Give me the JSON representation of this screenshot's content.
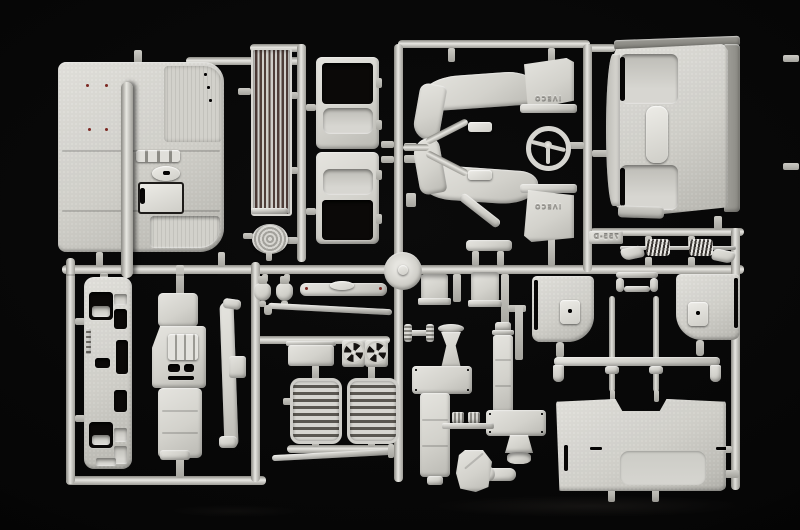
{
  "scene": {
    "description": "Macro photograph of a light grey injection-moulded model kit sprue (parts tree) with truck cab parts, laid on a black background",
    "background_color": "#050505",
    "plastic_highlight": "#e6e5e0",
    "plastic_base": "#d2d1cb",
    "plastic_shadow": "#96958f",
    "radiator_slot_color": "#4e3d38",
    "paint_dot_color": "#7c2822"
  },
  "embossed_text": {
    "mudflap_upper": "IVECO",
    "mudflap_lower": "IVECO",
    "sprue_tag": "755-D"
  },
  "parts": [
    "cab floor panel",
    "radiator grille",
    "filler cap",
    "cab door (upper)",
    "cab door (lower)",
    "wheel arch with IVECO mud flap (upper)",
    "wheel arch with IVECO mud flap (lower)",
    "steering wheel",
    "cab rear wall",
    "coil springs with shackles",
    "torsion rail",
    "door trim panel (left)",
    "door trim panel (right)",
    "roof bar with long pins",
    "cab rear lower panel",
    "front grille panel",
    "dashboard",
    "cab corner pillar",
    "air horns",
    "entry step bar",
    "hub cover disc",
    "wiper arm",
    "trim strip",
    "battery box",
    "cooling fans",
    "louvered vent panels",
    "air intake stack",
    "exhaust stack",
    "silencer boxes",
    "intake funnel",
    "exhaust funnel",
    "expansion tank",
    "elbow pipe",
    "t-valve",
    "sprue runners"
  ]
}
